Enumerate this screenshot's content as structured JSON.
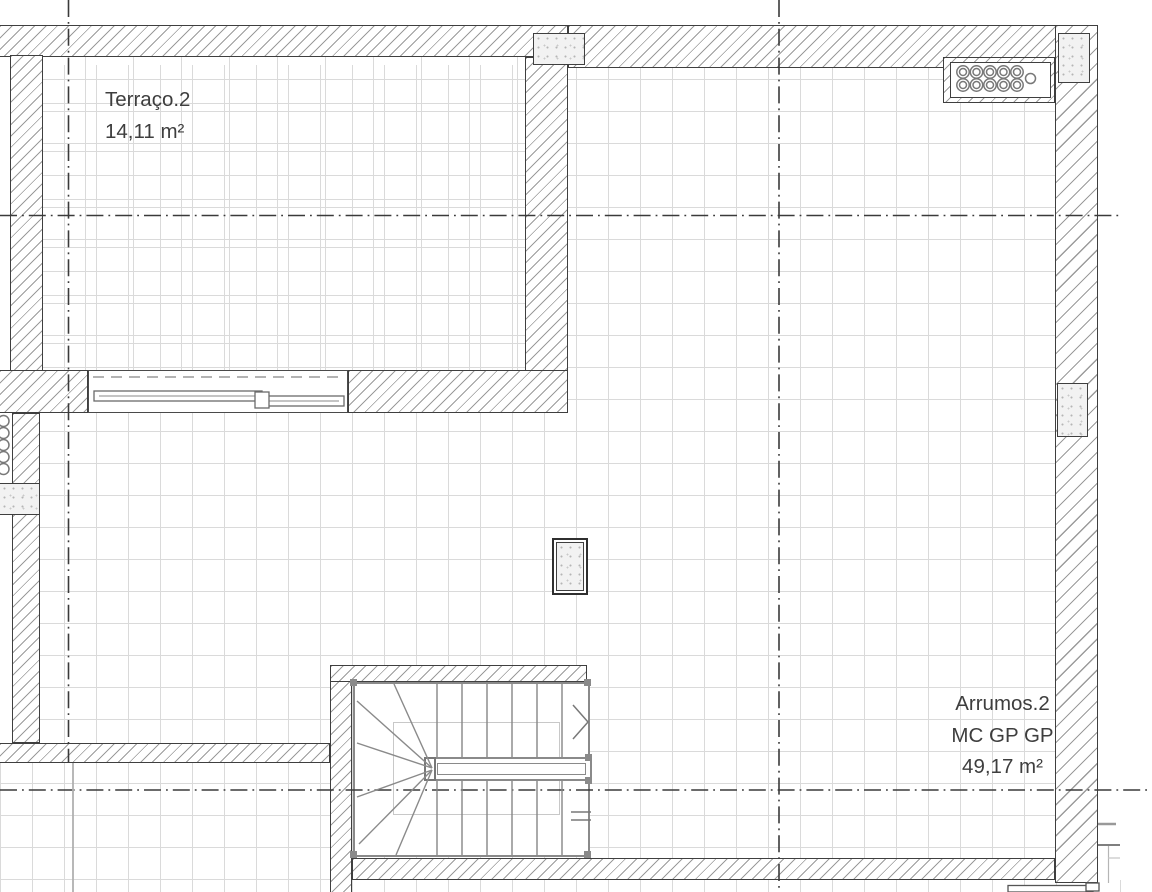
{
  "rooms": {
    "terrace": {
      "name": "Terraço.2",
      "area": "14,11 m²"
    },
    "storage": {
      "name": "Arrumos.2",
      "codes": "MC GP GP",
      "area": "49,17 m²"
    }
  },
  "colors": {
    "wall_outline": "#3f3f3f",
    "hatch": "#9b9b9b",
    "grid": "#dadada",
    "axis": "#3a3a3a",
    "stair": "#8a8a8a",
    "stipple_dot": "#b5b5b5",
    "text": "#3e3e3e"
  }
}
